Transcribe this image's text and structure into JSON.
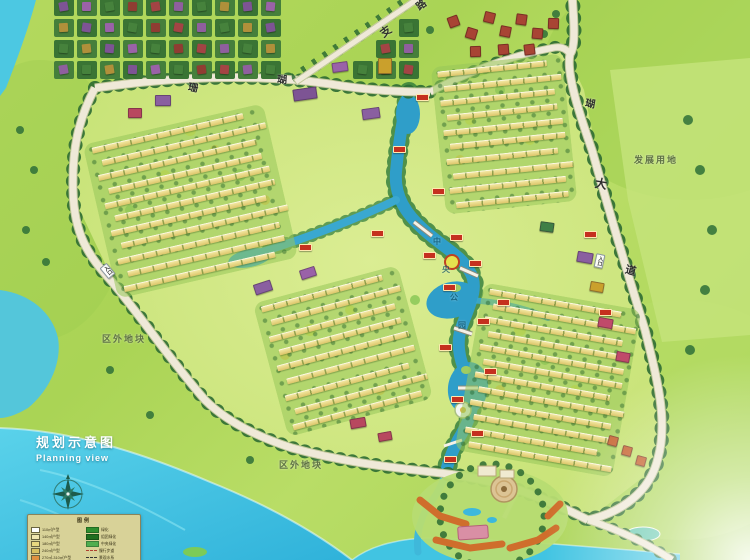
{
  "page": {
    "title_zh": "规划示意图",
    "title_en": "Planning view"
  },
  "legend": {
    "title": "图例",
    "left_items": [
      {
        "symbol_color": "#ffffff",
        "text": "110㎡户型"
      },
      {
        "symbol_color": "#f0e6b0",
        "text": "140㎡户型"
      },
      {
        "symbol_color": "#e8d880",
        "text": "180㎡户型"
      },
      {
        "symbol_color": "#d8c060",
        "text": "240㎡户型"
      },
      {
        "symbol_color": "#e09040",
        "text": "270㎡-310㎡户型"
      }
    ],
    "right_items": [
      {
        "swatch": "#2f8f2f",
        "style": "solid",
        "text": "绿化"
      },
      {
        "swatch": "#1f6f1f",
        "style": "solid",
        "text": "组团绿化"
      },
      {
        "swatch": "#4fae4f",
        "style": "solid",
        "text": "中央绿化"
      },
      {
        "swatch": "#b04030",
        "style": "dash",
        "text": "慢行步道"
      },
      {
        "swatch": "#333333",
        "style": "dash",
        "text": "景观水系"
      }
    ]
  },
  "map_labels": [
    {
      "id": "road-coral-char-1",
      "text": "珊",
      "x": 188,
      "y": 84,
      "size": 10,
      "color": "#2f2f2f",
      "rot": 10,
      "op": 1
    },
    {
      "id": "road-coral-char-2",
      "text": "瑚",
      "x": 277,
      "y": 76,
      "size": 10,
      "color": "#2f2f2f",
      "rot": 4,
      "op": 1
    },
    {
      "id": "branch-road-char-1",
      "text": "支",
      "x": 381,
      "y": 27,
      "size": 11,
      "color": "#2f2f2f",
      "rot": -36,
      "op": 1
    },
    {
      "id": "branch-road-char-2",
      "text": "路",
      "x": 417,
      "y": 1,
      "size": 10,
      "color": "#2f2f2f",
      "rot": -36,
      "op": 1
    },
    {
      "id": "avenue-char-hu",
      "text": "瑚",
      "x": 585,
      "y": 100,
      "size": 10,
      "color": "#2f2f2f",
      "rot": 10,
      "op": 1
    },
    {
      "id": "avenue-char-da",
      "text": "大",
      "x": 595,
      "y": 178,
      "size": 12,
      "color": "#2f2f2f",
      "rot": 10,
      "op": 1
    },
    {
      "id": "avenue-char-dao",
      "text": "道",
      "x": 625,
      "y": 266,
      "size": 11,
      "color": "#2f2f2f",
      "rot": 14,
      "op": 1
    },
    {
      "id": "entrance-west",
      "text": "入口",
      "x": 103,
      "y": 264,
      "size": 5,
      "color": "#333333",
      "rot": -40,
      "op": 1,
      "chip": true,
      "vertical": true
    },
    {
      "id": "entrance-east",
      "text": "入口",
      "x": 595,
      "y": 254,
      "size": 5,
      "color": "#333333",
      "rot": 12,
      "op": 1,
      "chip": true,
      "vertical": true
    },
    {
      "id": "outside-parcel-west",
      "text": "区外地块",
      "x": 102,
      "y": 335,
      "size": 9,
      "color": "#5f7245",
      "rot": 0,
      "op": 1,
      "ls": 2
    },
    {
      "id": "outside-parcel-south",
      "text": "区外地块",
      "x": 279,
      "y": 461,
      "size": 9,
      "color": "#5f7245",
      "rot": 0,
      "op": 1,
      "ls": 2
    },
    {
      "id": "development-land",
      "text": "发展用地",
      "x": 634,
      "y": 156,
      "size": 9,
      "color": "#5f7245",
      "rot": 0,
      "op": 1,
      "ls": 2
    },
    {
      "id": "central-park-char-1",
      "text": "中",
      "x": 433,
      "y": 238,
      "size": 8,
      "color": "#0f4f66",
      "rot": 0,
      "op": 0.7
    },
    {
      "id": "central-park-char-2",
      "text": "央",
      "x": 442,
      "y": 266,
      "size": 8,
      "color": "#0f4f66",
      "rot": 0,
      "op": 0.7
    },
    {
      "id": "central-park-char-3",
      "text": "公",
      "x": 450,
      "y": 294,
      "size": 8,
      "color": "#0f4f66",
      "rot": 0,
      "op": 0.7
    },
    {
      "id": "central-park-char-4",
      "text": "园",
      "x": 458,
      "y": 322,
      "size": 8,
      "color": "#0f4f66",
      "rot": 0,
      "op": 0.7
    }
  ],
  "villa_grid": {
    "x": 54,
    "y": -2,
    "cols": 16,
    "rows": 4,
    "cell_w": 23,
    "cell_h": 21,
    "lot_color_a": "#457f3b",
    "lot_color_b": "#3a7434",
    "roof_palette": [
      "#7d5494",
      "#8f3d32",
      "#46823c",
      "#9a62a8",
      "#a34444",
      "#b0903a",
      "#46823c",
      "#8f5f9e"
    ]
  },
  "red_villas": {
    "color": "#a84434",
    "positions": [
      [
        448,
        16
      ],
      [
        466,
        28
      ],
      [
        484,
        12
      ],
      [
        500,
        26
      ],
      [
        516,
        14
      ],
      [
        532,
        28
      ],
      [
        548,
        18
      ],
      [
        470,
        46
      ],
      [
        498,
        44
      ],
      [
        524,
        44
      ]
    ]
  },
  "clusters": [
    {
      "id": "cluster-northeast",
      "x": 438,
      "y": 60,
      "w": 132,
      "h": 148,
      "rot": -6,
      "rows": 10
    },
    {
      "id": "cluster-west",
      "x": 98,
      "y": 122,
      "w": 185,
      "h": 158,
      "rot": -13,
      "rows": 11
    },
    {
      "id": "cluster-central",
      "x": 268,
      "y": 282,
      "w": 150,
      "h": 138,
      "rot": -15,
      "rows": 9
    },
    {
      "id": "cluster-southeast",
      "x": 468,
      "y": 295,
      "w": 160,
      "h": 170,
      "rot": 10,
      "rows": 12
    }
  ],
  "accents": [
    {
      "x": 293,
      "y": 88,
      "w": 22,
      "h": 10,
      "c": "#7d5494",
      "rot": -8
    },
    {
      "x": 362,
      "y": 108,
      "w": 16,
      "h": 9,
      "c": "#8a5fa0",
      "rot": -8
    },
    {
      "x": 332,
      "y": 62,
      "w": 14,
      "h": 8,
      "c": "#9a62a8",
      "rot": -8
    },
    {
      "x": 378,
      "y": 58,
      "w": 12,
      "h": 14,
      "c": "#caa02c",
      "rot": 0
    },
    {
      "x": 254,
      "y": 282,
      "w": 16,
      "h": 9,
      "c": "#8a5fa0",
      "rot": -18
    },
    {
      "x": 300,
      "y": 268,
      "w": 14,
      "h": 8,
      "c": "#9a62a8",
      "rot": -18
    },
    {
      "x": 577,
      "y": 252,
      "w": 14,
      "h": 9,
      "c": "#8a5fa0",
      "rot": 10
    },
    {
      "x": 598,
      "y": 318,
      "w": 13,
      "h": 8,
      "c": "#c04a6a",
      "rot": 10
    },
    {
      "x": 616,
      "y": 352,
      "w": 12,
      "h": 8,
      "c": "#c04a6a",
      "rot": 10
    },
    {
      "x": 590,
      "y": 282,
      "w": 12,
      "h": 8,
      "c": "#caa02c",
      "rot": 10
    },
    {
      "x": 350,
      "y": 418,
      "w": 14,
      "h": 8,
      "c": "#b8485f",
      "rot": -10
    },
    {
      "x": 378,
      "y": 432,
      "w": 12,
      "h": 7,
      "c": "#b8485f",
      "rot": -10
    },
    {
      "x": 540,
      "y": 222,
      "w": 12,
      "h": 8,
      "c": "#3f7f46",
      "rot": 8
    },
    {
      "x": 155,
      "y": 95,
      "w": 14,
      "h": 9,
      "c": "#8a5fa0",
      "rot": 0
    },
    {
      "x": 128,
      "y": 108,
      "w": 12,
      "h": 8,
      "c": "#b8485f",
      "rot": 0
    },
    {
      "x": 608,
      "y": 436,
      "w": 8,
      "h": 8,
      "c": "#c86a38",
      "rot": 15
    },
    {
      "x": 622,
      "y": 446,
      "w": 8,
      "h": 8,
      "c": "#c86a38",
      "rot": 15
    },
    {
      "x": 636,
      "y": 456,
      "w": 8,
      "h": 8,
      "c": "#c86a38",
      "rot": 15
    }
  ],
  "markers": [
    [
      416,
      94
    ],
    [
      393,
      146
    ],
    [
      371,
      230
    ],
    [
      299,
      244
    ],
    [
      432,
      188
    ],
    [
      450,
      234
    ],
    [
      423,
      252
    ],
    [
      469,
      260
    ],
    [
      443,
      284
    ],
    [
      477,
      318
    ],
    [
      439,
      344
    ],
    [
      484,
      368
    ],
    [
      451,
      396
    ],
    [
      471,
      430
    ],
    [
      444,
      456
    ],
    [
      497,
      299
    ],
    [
      584,
      231
    ],
    [
      599,
      309
    ]
  ],
  "colors": {
    "sea": "#3fc4e2",
    "river": "#2f9ec9",
    "land_outer": "#aad455",
    "land_site": "#d8eb8c",
    "road": "#efe9d8",
    "tree": "#2d6b33",
    "roof_yellow": "#ead47a",
    "accent_purple": "#8a5fa0",
    "marker_red": "#c5301f",
    "legend_bg": "#d8d298",
    "title_text": "#ffffff"
  }
}
